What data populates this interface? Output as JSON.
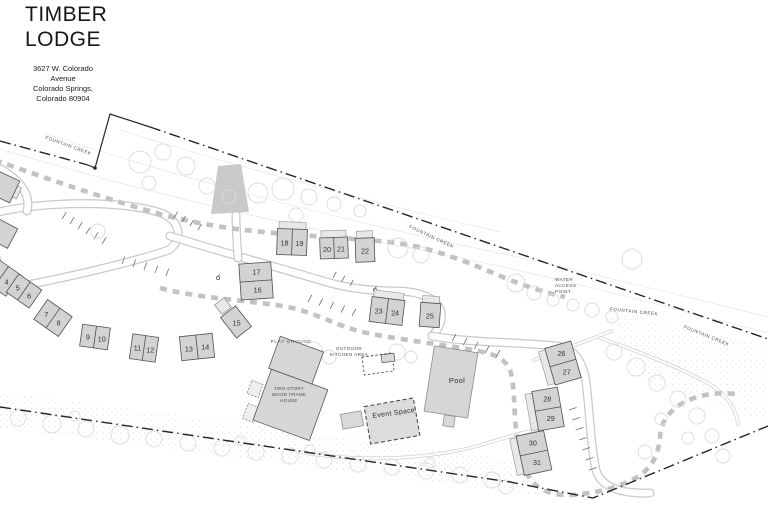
{
  "header": {
    "title_lines": [
      "TIMBER",
      "LODGE"
    ],
    "address_lines": [
      "3627 W. Colorado",
      "Avenue",
      "Colorado Springs,",
      "Colorado 80904"
    ]
  },
  "colors": {
    "boundary": "#262626",
    "building_fill": "#d3d3d3",
    "building_stroke": "#4f4f4f",
    "porch_fill": "#e8e8e8",
    "porch_stroke": "#909090",
    "road_casing": "#c9c9c9",
    "path_dash": "#c2c2c2",
    "tree_stroke": "#dcdcdc",
    "label_color": "#4d4d4d",
    "number_color": "#333333"
  },
  "map": {
    "boundary": {
      "segments": [
        {
          "d": "M 0,141 L 88,165",
          "style": "dashdot"
        },
        {
          "d": "M 88,165 L 95,168 L 110,114 L 150,127",
          "style": "solid"
        },
        {
          "d": "M 150,127 L 768,339",
          "style": "dashdot"
        },
        {
          "d": "M 0,407 L 250,444 L 510,482 L 593,498 L 768,426",
          "style": "dashdot"
        }
      ],
      "vertex_dot": [
        95,
        168
      ]
    },
    "creek_contours": [
      {
        "id": "creek-contour-1",
        "d": "M 0,149 C 130,188 270,222 405,247 C 525,269 645,301 768,333"
      },
      {
        "id": "creek-contour-2",
        "d": "M 46,134 C 186,180 326,216 466,246 C 586,271 686,297 768,317"
      },
      {
        "id": "creek-contour-3",
        "d": "M 120,130 C 240,168 380,204 500,232"
      }
    ],
    "stipple_bands": [
      {
        "id": "stipple-bottom",
        "points": "0,392 530,462 542,496 0,428"
      },
      {
        "id": "stipple-right",
        "points": "600,310 768,346 768,422 642,382"
      }
    ],
    "roads": [
      {
        "id": "road-loop-west",
        "d": "M -6,213 C 45,201 122,200 161,213 C 180,220 184,239 169,250 C 130,263 60,279 21,286 C 1,290 -9,258 -6,213 Z"
      },
      {
        "id": "road-entry-spur",
        "d": "M 1,169 C 21,181 31,195 27,211"
      },
      {
        "id": "road-main-west",
        "d": "M 170,236 C 225,253 280,268 330,283 C 352,289 372,291 396,291 C 420,291 438,299 441,312 C 443,325 434,334 432,336"
      },
      {
        "id": "road-main-east",
        "d": "M 432,336 C 470,343 520,342 556,346 C 575,348 583,362 586,382 C 590,415 591,448 596,470 C 601,487 620,494 650,493"
      },
      {
        "id": "road-bridge-stub",
        "d": "M 238,258 C 237,243 236,228 236,215"
      },
      {
        "id": "road-south-trail",
        "d": "M 300,452 C 360,463 432,459 481,445 C 511,436 531,430 546,428",
        "thin": true
      },
      {
        "id": "trail-water-access",
        "d": "M 534,360 C 560,350 586,342 611,331",
        "thin": true
      },
      {
        "id": "road-creek-east",
        "d": "M 600,338 C 640,352 680,368 706,382 C 726,393 736,408 738,424",
        "thin": true
      }
    ],
    "boardwalks": [
      {
        "id": "path-creek",
        "d": "M -5,160 C 50,180 110,200 160,214 C 212,228 258,232 300,235 C 342,238 372,240 398,243 C 436,249 470,263 505,278 C 530,288 548,293 565,297"
      },
      {
        "id": "path-main-loop",
        "d": "M 160,288 C 195,298 256,301 288,307 C 320,314 338,327 367,333 C 407,341 449,345 483,352 C 501,356 508,363 511,373 C 514,386 514,401 515,418 C 517,444 521,463 529,477 C 537,490 553,496 572,495 C 598,493 621,487 639,476 C 653,467 659,452 660,437 C 661,422 669,410 685,402 C 700,394 718,392 736,394"
      }
    ],
    "bridge": {
      "points": "218,166 241,164 249,212 211,214"
    },
    "parking": [
      {
        "id": "parking-1",
        "x1": 62,
        "y1": 219,
        "x2": 102,
        "y2": 244,
        "n": 6,
        "len": 8,
        "angle": -58
      },
      {
        "id": "parking-2",
        "x1": 122,
        "y1": 264,
        "x2": 166,
        "y2": 276,
        "n": 5,
        "len": 8,
        "angle": -70
      },
      {
        "id": "parking-3",
        "x1": 174,
        "y1": 218,
        "x2": 198,
        "y2": 230,
        "n": 4,
        "len": 7,
        "angle": -60
      },
      {
        "id": "parking-4",
        "x1": 308,
        "y1": 302,
        "x2": 352,
        "y2": 316,
        "n": 5,
        "len": 8,
        "angle": -62
      },
      {
        "id": "parking-5",
        "x1": 456,
        "y1": 334,
        "x2": 500,
        "y2": 350,
        "n": 5,
        "len": 8,
        "angle": 118
      },
      {
        "id": "parking-6",
        "x1": 569,
        "y1": 410,
        "x2": 589,
        "y2": 470,
        "n": 7,
        "len": 8,
        "angle": -18
      },
      {
        "id": "parking-7",
        "x1": 333,
        "y1": 278,
        "x2": 350,
        "y2": 286,
        "n": 3,
        "len": 7,
        "angle": -62
      }
    ],
    "trees": [
      [
        140,
        162,
        11
      ],
      [
        163,
        152,
        8
      ],
      [
        186,
        166,
        9
      ],
      [
        149,
        183,
        7
      ],
      [
        207,
        186,
        8
      ],
      [
        229,
        197,
        7
      ],
      [
        258,
        193,
        10
      ],
      [
        283,
        189,
        11
      ],
      [
        309,
        197,
        8
      ],
      [
        334,
        204,
        7
      ],
      [
        360,
        211,
        6
      ],
      [
        398,
        248,
        10
      ],
      [
        421,
        255,
        8
      ],
      [
        98,
        231,
        7
      ],
      [
        296,
        215,
        7
      ],
      [
        516,
        283,
        9
      ],
      [
        534,
        293,
        7
      ],
      [
        553,
        300,
        6
      ],
      [
        573,
        305,
        6
      ],
      [
        592,
        310,
        7
      ],
      [
        612,
        317,
        6
      ],
      [
        632,
        259,
        10
      ],
      [
        614,
        352,
        8
      ],
      [
        636,
        367,
        9
      ],
      [
        657,
        383,
        8
      ],
      [
        678,
        399,
        8
      ],
      [
        697,
        416,
        8
      ],
      [
        712,
        436,
        7
      ],
      [
        723,
        456,
        7
      ],
      [
        688,
        438,
        6
      ],
      [
        661,
        419,
        6
      ],
      [
        645,
        452,
        7
      ],
      [
        18,
        418,
        8
      ],
      [
        52,
        424,
        9
      ],
      [
        86,
        429,
        8
      ],
      [
        120,
        435,
        9
      ],
      [
        154,
        439,
        8
      ],
      [
        188,
        443,
        8
      ],
      [
        222,
        448,
        8
      ],
      [
        256,
        452,
        8
      ],
      [
        290,
        456,
        8
      ],
      [
        324,
        460,
        8
      ],
      [
        358,
        464,
        8
      ],
      [
        392,
        467,
        8
      ],
      [
        426,
        471,
        8
      ],
      [
        460,
        475,
        8
      ],
      [
        492,
        480,
        8
      ],
      [
        75,
        416,
        5
      ],
      [
        240,
        441,
        5
      ],
      [
        310,
        450,
        5
      ],
      [
        430,
        463,
        5
      ],
      [
        506,
        487,
        7
      ],
      [
        313,
        351,
        9
      ],
      [
        329,
        357,
        7
      ],
      [
        397,
        352,
        8
      ],
      [
        411,
        357,
        6
      ]
    ],
    "markers": [
      [
        218,
        278
      ],
      [
        375,
        290
      ]
    ],
    "structures": [
      {
        "id": "house-annex-1",
        "cx": 255,
        "cy": 389,
        "rot": 20,
        "fill": "#efefef",
        "stroke": "#7a7a7a",
        "sw": 0.7,
        "dash": "2 1.5",
        "parts": [
          {
            "dx": 0,
            "dy": 0,
            "w": 12,
            "h": 14
          }
        ]
      },
      {
        "id": "house-annex-2",
        "cx": 251,
        "cy": 413,
        "rot": 20,
        "fill": "#efefef",
        "stroke": "#7a7a7a",
        "sw": 0.7,
        "dash": "2 1.5",
        "parts": [
          {
            "dx": 0,
            "dy": 0,
            "w": 12,
            "h": 16
          }
        ]
      },
      {
        "id": "annex-west",
        "cx": 14,
        "cy": 191,
        "rot": 25,
        "fill": "#e9e9e9",
        "stroke": "#8a8a8a",
        "sw": 0.7,
        "parts": [
          {
            "dx": 0,
            "dy": 0,
            "w": 11,
            "h": 12
          }
        ]
      },
      {
        "id": "annex-cabin-15",
        "cx": 223,
        "cy": 306,
        "rot": -38,
        "fill": "#e9e9e9",
        "stroke": "#8a8a8a",
        "sw": 0.7,
        "parts": [
          {
            "dx": 0,
            "dy": 0,
            "w": 12,
            "h": 12
          }
        ]
      },
      {
        "id": "outdoor-kitchen-pad",
        "cx": 378,
        "cy": 364,
        "rot": -8,
        "fill": "none",
        "stroke": "#3f3f3f",
        "sw": 0.8,
        "dash": "2.5 2",
        "parts": [
          {
            "dx": 0,
            "dy": 0,
            "w": 30,
            "h": 18
          }
        ]
      },
      {
        "id": "outdoor-kitchen-grill",
        "cx": 388,
        "cy": 358,
        "rot": -8,
        "fill": "#d9d9d9",
        "stroke": "#4a4a4a",
        "sw": 0.7,
        "parts": [
          {
            "dx": 0,
            "dy": 0,
            "w": 13,
            "h": 8
          }
        ]
      },
      {
        "id": "event-space-annex",
        "cx": 352,
        "cy": 420,
        "rot": -10,
        "fill": "#d9d9d9",
        "stroke": "#8a8a8a",
        "sw": 0.7,
        "parts": [
          {
            "dx": 0,
            "dy": 0,
            "w": 21,
            "h": 15
          }
        ]
      },
      {
        "id": "event-space",
        "cx": 392,
        "cy": 421,
        "rot": -10,
        "fill": "#dcdcdc",
        "stroke": "#3f3f3f",
        "sw": 1,
        "dash": "4 2.5",
        "parts": [
          {
            "dx": 0,
            "dy": 0,
            "w": 50,
            "h": 38
          }
        ]
      },
      {
        "id": "pool-equipment",
        "cx": 449,
        "cy": 421,
        "rot": 9,
        "fill": "#d9d9d9",
        "stroke": "#8a8a8a",
        "sw": 0.7,
        "parts": [
          {
            "dx": 0,
            "dy": 0,
            "w": 11,
            "h": 11
          }
        ]
      },
      {
        "id": "pool",
        "cx": 451,
        "cy": 382,
        "rot": 9,
        "fill": "#d6d6d6",
        "stroke": "#8a8a8a",
        "sw": 0.8,
        "parts": [
          {
            "dx": 0,
            "dy": 0,
            "w": 44,
            "h": 66
          }
        ]
      },
      {
        "id": "two-story-house",
        "cx": 293,
        "cy": 392,
        "rot": 20,
        "fill": "#d6d6d6",
        "stroke": "#565656",
        "sw": 0.8,
        "parts": [
          {
            "dx": 2,
            "dy": 13,
            "w": 60,
            "h": 54
          },
          {
            "dx": -8,
            "dy": -31,
            "w": 46,
            "h": 34
          }
        ]
      }
    ],
    "cabins": [
      {
        "id": "building-west-a",
        "cx": 2,
        "cy": 186,
        "w": 28,
        "h": 24,
        "rot": 25,
        "units": []
      },
      {
        "id": "building-west-b",
        "cx": 2,
        "cy": 233,
        "w": 24,
        "h": 22,
        "rot": 28,
        "units": []
      },
      {
        "id": "cabin-4",
        "cx": 1,
        "cy": 277,
        "w": 30,
        "h": 26,
        "rot": 35,
        "split": "v",
        "units": [
          "",
          "4"
        ]
      },
      {
        "id": "cabin-5-6",
        "cx": 24,
        "cy": 291,
        "w": 28,
        "h": 22,
        "rot": 35,
        "split": "v",
        "units": [
          "5",
          "6"
        ]
      },
      {
        "id": "cabin-7-8",
        "cx": 53,
        "cy": 318,
        "w": 30,
        "h": 24,
        "rot": 35,
        "split": "v",
        "units": [
          "7",
          "8"
        ]
      },
      {
        "id": "cabin-9-10",
        "cx": 95,
        "cy": 337,
        "w": 28,
        "h": 22,
        "rot": 8,
        "split": "v",
        "units": [
          "9",
          "10"
        ]
      },
      {
        "id": "cabin-11-12",
        "cx": 144,
        "cy": 348,
        "w": 26,
        "h": 25,
        "rot": 8,
        "split": "v",
        "units": [
          "11",
          "12"
        ]
      },
      {
        "id": "cabin-13-14",
        "cx": 197,
        "cy": 347,
        "w": 33,
        "h": 24,
        "rot": -6,
        "split": "v",
        "units": [
          "13",
          "14"
        ]
      },
      {
        "id": "cabin-15",
        "cx": 236,
        "cy": 322,
        "w": 19,
        "h": 26,
        "rot": -38,
        "units": [
          "15"
        ]
      },
      {
        "id": "cabin-16-17",
        "cx": 256,
        "cy": 281,
        "w": 32,
        "h": 36,
        "rot": -4,
        "split": "h",
        "units": [
          "17",
          "16"
        ]
      },
      {
        "id": "cabin-18-19",
        "cx": 292,
        "cy": 242,
        "w": 30,
        "h": 26,
        "rot": 2,
        "split": "v",
        "units": [
          "18",
          "19"
        ],
        "porch": "top"
      },
      {
        "id": "cabin-20-21",
        "cx": 334,
        "cy": 248,
        "w": 28,
        "h": 21,
        "rot": -2,
        "split": "v",
        "units": [
          "20",
          "21"
        ],
        "porch": "top"
      },
      {
        "id": "cabin-22",
        "cx": 365,
        "cy": 250,
        "w": 19,
        "h": 24,
        "rot": -2,
        "units": [
          "22"
        ],
        "porch": "top"
      },
      {
        "id": "cabin-23-24",
        "cx": 387,
        "cy": 311,
        "w": 33,
        "h": 25,
        "rot": 7,
        "split": "v",
        "units": [
          "23",
          "24"
        ],
        "porch": "top"
      },
      {
        "id": "cabin-25",
        "cx": 430,
        "cy": 315,
        "w": 20,
        "h": 24,
        "rot": 4,
        "units": [
          "25"
        ],
        "porch": "top"
      },
      {
        "id": "cabin-26-27",
        "cx": 563,
        "cy": 363,
        "w": 27,
        "h": 38,
        "rot": -16,
        "split": "h",
        "units": [
          "26",
          "27"
        ],
        "porch": "left"
      },
      {
        "id": "cabin-28-29",
        "cx": 548,
        "cy": 409,
        "w": 26,
        "h": 40,
        "rot": -10,
        "split": "h",
        "units": [
          "28",
          "29"
        ],
        "porch": "left"
      },
      {
        "id": "cabin-30-31",
        "cx": 534,
        "cy": 453,
        "w": 28,
        "h": 40,
        "rot": -12,
        "split": "h",
        "units": [
          "30",
          "31"
        ],
        "porch": "left"
      }
    ],
    "labels": [
      {
        "id": "label-fountain-creek-1",
        "text": "FOUNTAIN CREEK",
        "x": 68,
        "y": 147,
        "rot": 20,
        "size": 4.6,
        "ls": 0.6
      },
      {
        "id": "label-fountain-creek-2",
        "text": "FOUNTAIN CREEK",
        "x": 431,
        "y": 238,
        "rot": 25,
        "size": 4.6,
        "ls": 0.6
      },
      {
        "id": "label-fountain-creek-3",
        "text": "FOUNTAIN CREEK",
        "x": 634,
        "y": 313,
        "rot": 6,
        "size": 4.6,
        "ls": 0.6
      },
      {
        "id": "label-fountain-creek-4",
        "text": "FOUNTAIN CREEK",
        "x": 706,
        "y": 337,
        "rot": 22,
        "size": 4.6,
        "ls": 0.6
      },
      {
        "id": "label-water-access-point",
        "text": "WATER\nACCESS\nPOINT",
        "x": 555,
        "y": 281,
        "rot": 0,
        "size": 4.6,
        "ls": 0.4,
        "anchor": "start",
        "lh": 6
      },
      {
        "id": "label-play-ground",
        "text": "PLAY GROUND",
        "x": 291,
        "y": 343,
        "rot": 0,
        "size": 4.6,
        "ls": 0.7
      },
      {
        "id": "label-outdoor-kitchen-area",
        "text": "OUTDOOR\nKITCHEN AREA",
        "x": 349,
        "y": 350,
        "rot": 0,
        "size": 4.6,
        "ls": 0.4,
        "lh": 6
      },
      {
        "id": "label-two-story-house",
        "text": "TWO-STORY\nWOOD FRAME\nHOUSE",
        "x": 289,
        "y": 390,
        "rot": 0,
        "size": 4.5,
        "ls": 0.3,
        "lh": 6
      },
      {
        "id": "label-pool",
        "text": "Pool",
        "x": 457,
        "y": 383,
        "rot": 0,
        "size": 7.5,
        "ls": 0.3,
        "color": "#2e2e2e"
      },
      {
        "id": "label-event-space",
        "text": "Event Space",
        "x": 394,
        "y": 415,
        "rot": -8,
        "size": 7,
        "ls": 0.3,
        "color": "#2e2e2e"
      }
    ]
  }
}
